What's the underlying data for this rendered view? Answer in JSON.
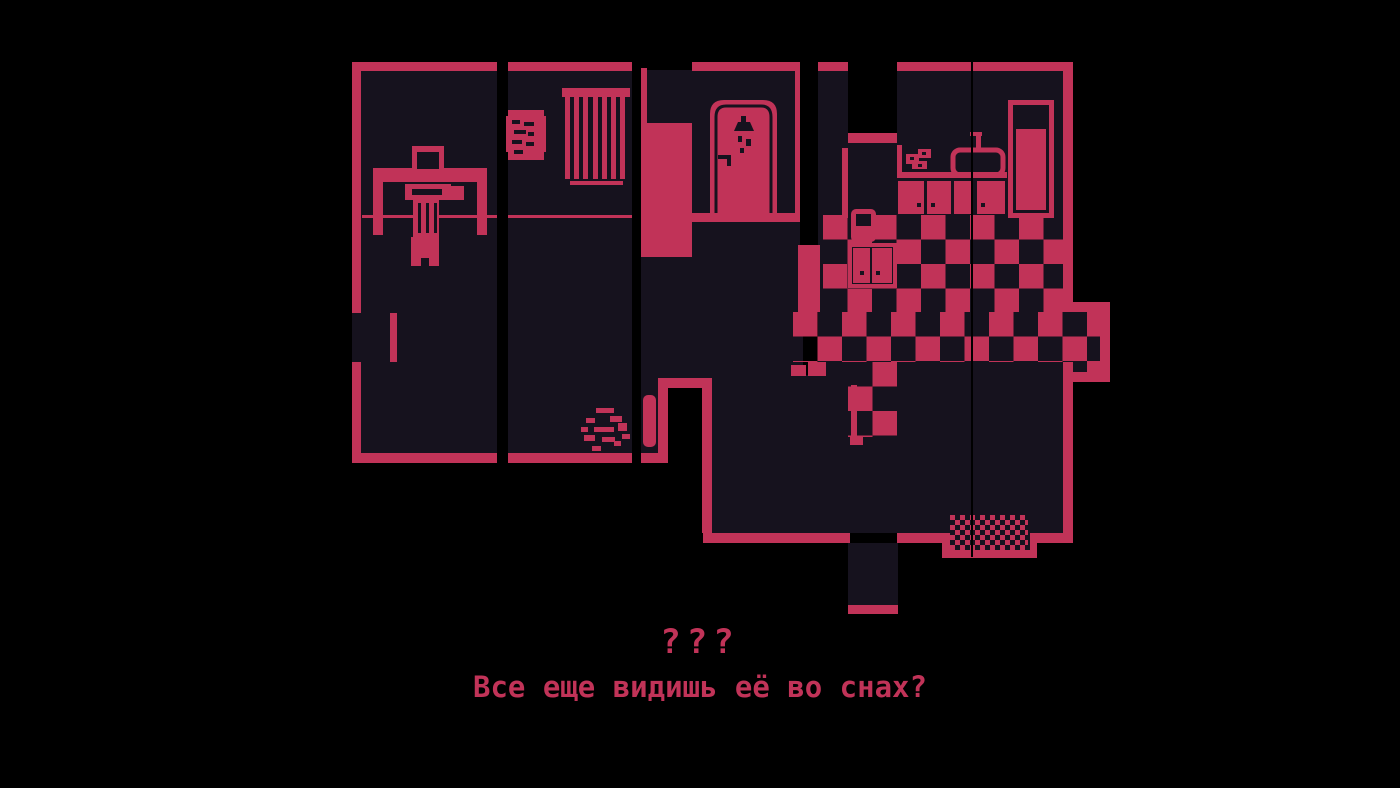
{
  "palette": {
    "background": "#000000",
    "floor": "#16121e",
    "ink": "#c13358"
  },
  "ui": {
    "dialogue": {
      "speaker_name": "???",
      "text": "Все еще видишь её во снах?"
    }
  },
  "scene": {
    "description": "1-bit pixel-art top-down apartment floor plan, crimson on black",
    "rooms": [
      {
        "name": "study",
        "objects": [
          "desk",
          "computer-monitor",
          "keyboard",
          "mouse",
          "person-on-chair",
          "balcony-doorway"
        ]
      },
      {
        "name": "bedroom",
        "objects": [
          "wall-poster",
          "window-blinds",
          "debris-pile"
        ]
      },
      {
        "name": "bathroom",
        "objects": [
          "shower-door",
          "shower-head",
          "door-handle"
        ]
      },
      {
        "name": "hallway",
        "objects": [
          "open-door",
          "door-leaf",
          "slippers"
        ]
      },
      {
        "name": "kitchen",
        "objects": [
          "counter",
          "sink",
          "faucet",
          "dishes",
          "lower-cabinets",
          "wall-cabinet",
          "chair",
          "fridge",
          "checkered-floor"
        ]
      },
      {
        "name": "entrance",
        "objects": [
          "doormat",
          "exit-corridor",
          "side-nook"
        ]
      }
    ]
  }
}
